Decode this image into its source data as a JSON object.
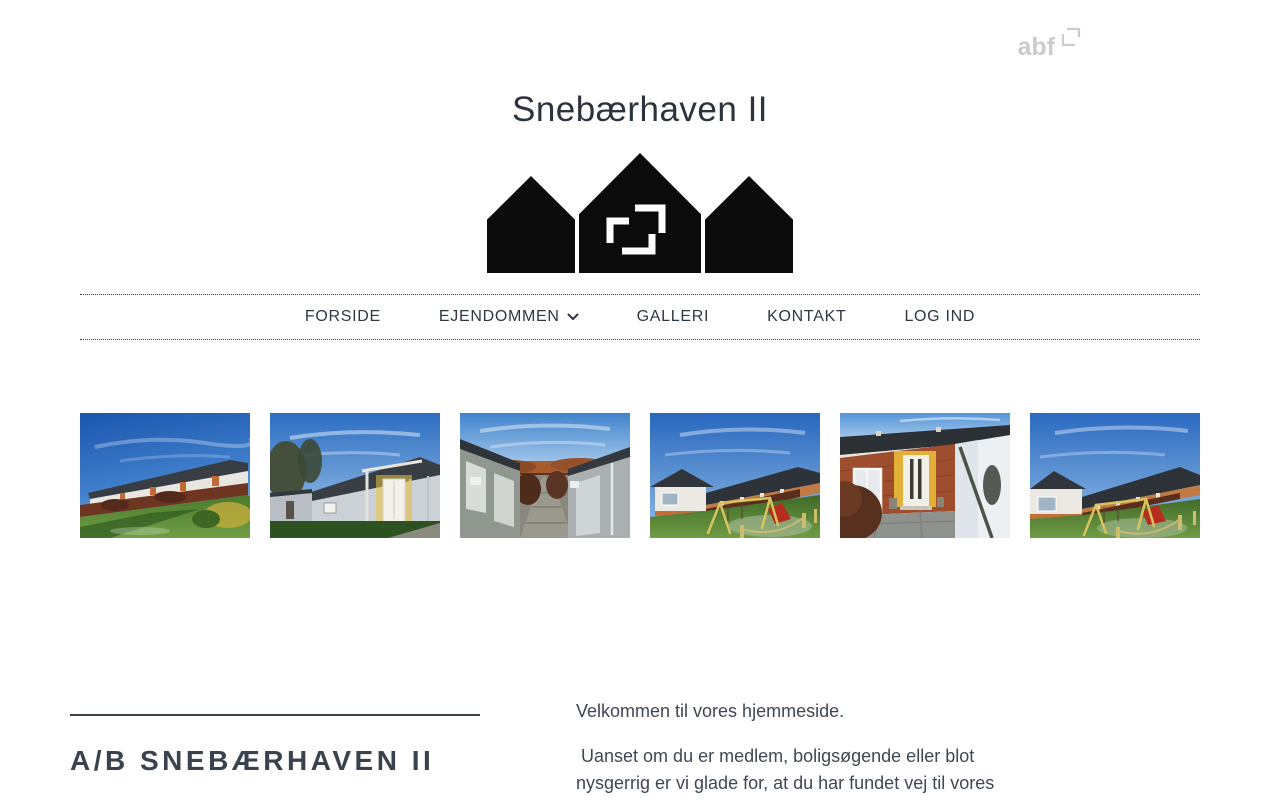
{
  "header": {
    "abf_text": "abf",
    "title": "Snebærhaven II"
  },
  "nav": {
    "items": [
      {
        "label": "FORSIDE"
      },
      {
        "label": "EJENDOMMEN"
      },
      {
        "label": "GALLERI"
      },
      {
        "label": "KONTAKT"
      },
      {
        "label": "LOG IND"
      }
    ]
  },
  "gallery": {
    "images": [
      {
        "name": "row-houses-green-lawn"
      },
      {
        "name": "house-white-door-pergola"
      },
      {
        "name": "path-between-sheds"
      },
      {
        "name": "playground-swings-houses"
      },
      {
        "name": "brick-entrance-white-door"
      },
      {
        "name": "playground-houses-cars"
      }
    ]
  },
  "about": {
    "heading": "A/B SNEBÆRHAVEN II",
    "welcome": "Velkommen til vores hjemmeside.",
    "paragraph": " Uanset om du er medlem, boligsøgende eller blot nysgerrig er vi glade for, at du har fundet vej til vores"
  },
  "colors": {
    "title": "#2d333d",
    "nav_text": "#2f3743",
    "heading": "#3a424d",
    "body_text": "#3f4753",
    "abf_gray": "#c9cbce",
    "logo_black": "#0b0b0b"
  }
}
